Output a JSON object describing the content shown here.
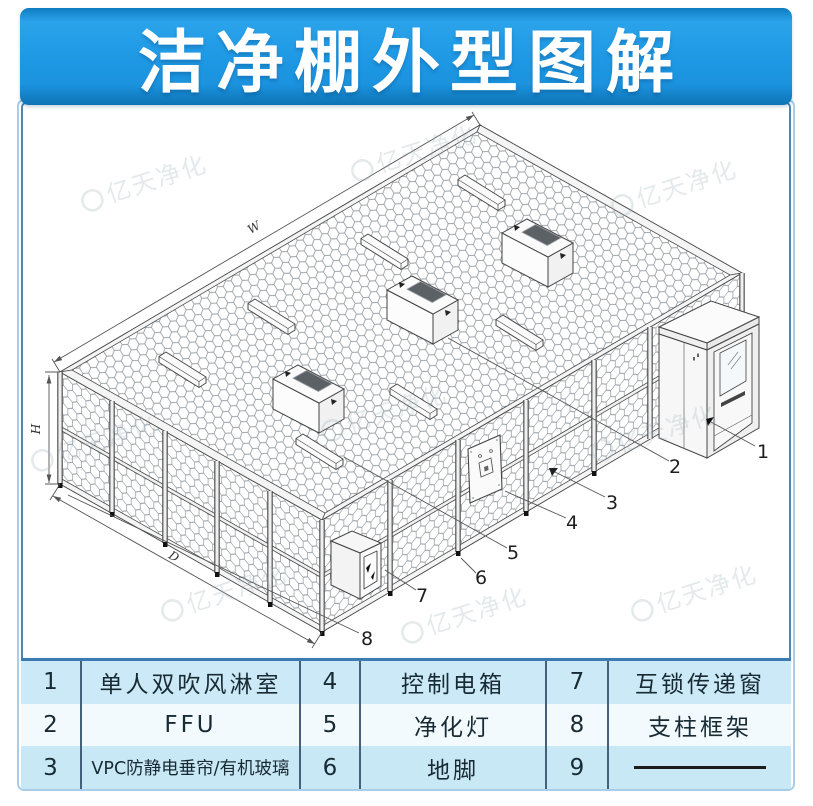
{
  "header": {
    "title": "洁净棚外型图解"
  },
  "diagram": {
    "callouts": [
      "1",
      "2",
      "3",
      "4",
      "5",
      "6",
      "7",
      "8"
    ],
    "dimensions": {
      "width_label": "W",
      "height_label": "H",
      "depth_label": "D"
    },
    "watermark": "亿天净化"
  },
  "table": {
    "rows": [
      {
        "c1num": "1",
        "c1": "单人双吹风淋室",
        "c2num": "4",
        "c2": "控制电箱",
        "c3num": "7",
        "c3": "互锁传递窗"
      },
      {
        "c1num": "2",
        "c1": "FFU",
        "c2num": "5",
        "c2": "净化灯",
        "c3num": "8",
        "c3": "支柱框架"
      },
      {
        "c1num": "3",
        "c1": "VPC防静电垂帘/有机玻璃",
        "c2num": "6",
        "c2": "地脚",
        "c3num": "9",
        "c3": ""
      }
    ]
  }
}
